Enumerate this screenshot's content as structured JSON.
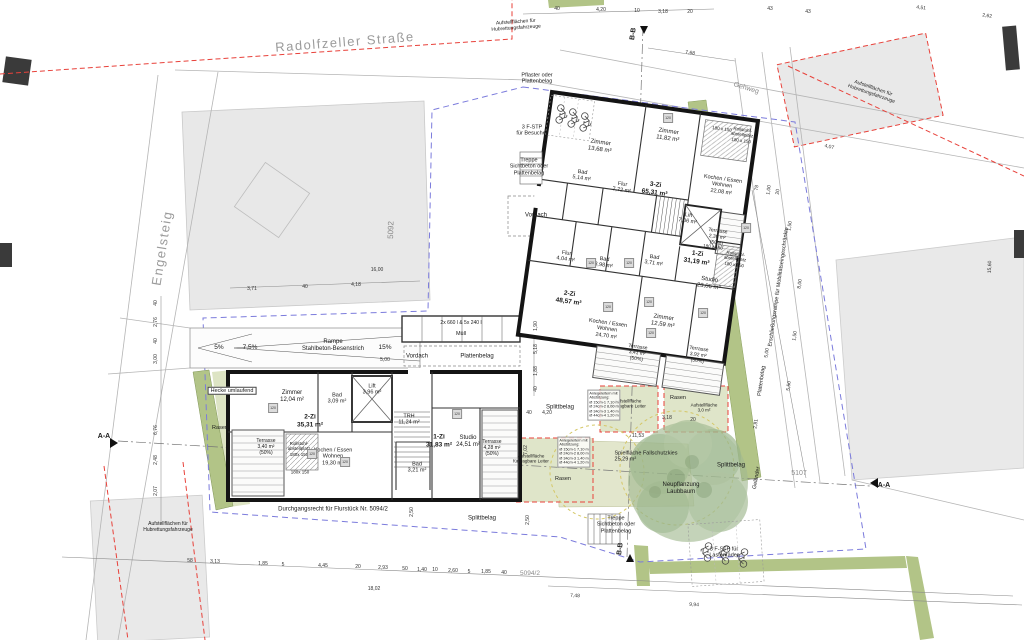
{
  "streets": {
    "main": "Radolfzeller Straße",
    "side": "Engelsteig",
    "gehweg": "Gehweg"
  },
  "parcels": {
    "p5092": "5092",
    "p5107": "5107",
    "p5094": "5094/2"
  },
  "fire": {
    "hub": "Aufstellflächen für\nHubrettungsfahrzeuge",
    "ladder": "Aufstellfläche\nfür tragbare Leiter",
    "ladder2": "Aufstellfläche\n3,0 m²",
    "ladder_note": "Anlegeleitern mit\nAbstützung:\nØ 15cm-1  7,10 m\nØ 24cm-2  8,00 m\nØ 34cm-3  1,40 m\nØ 44cm-4  1,20 m",
    "rasen": "Rasen"
  },
  "landscape": {
    "hecke": "Hecke umlaufend",
    "rasen": "Rasen",
    "spielflaeche": "Spielfläche Fallschutzkies\n25,29 m²",
    "baum": "Neupflanzung\nLaubbaum"
  },
  "surfaces": {
    "pflaster": "Pflaster oder\nPlattenbelag",
    "treppe": "Treppe\nSichtbeton oder\nPlattenbelag",
    "splittbelag": "Splittbelag",
    "plattenbelag": "Plattenbelag",
    "vordach": "Vordach",
    "muell_line1": "2x 660 l  &  5x 240 l",
    "muell_line2": "Müll",
    "rampe": "Rampe\nStahlbeton-Besenstrich",
    "pct5": "5%",
    "pct75": "7,5%",
    "pct15": "15%",
    "durchgangsrecht": "Durchgangsrecht für Flurstück Nr. 5094/2",
    "stp_besucher": "3 F-STP\nfür Besucher",
    "stp_lasten": "3 F-STP für\nLastenräder",
    "erschliessung": "Erschließungsrampe für Mobilitätseingeschränkte",
    "gelaender": "Geländer"
  },
  "sections": {
    "aa": "A-A",
    "bb": "B-B"
  },
  "rooms_upper": {
    "zimmer1": "Zimmer\n13,68 m²",
    "zimmer2": "Zimmer\n11,82 m²",
    "bad1": "Bad\n5,14 m²",
    "flur1": "Flur\n7,72 m²",
    "unit3": "3-Zi\n65,31 m²",
    "kochen1": "Kochen / Essen\nWohnen\n22,08 m²",
    "rollstuhl": "Rollstuhl-\nabstellplatz\n180 x 150",
    "turn": "180 x 150",
    "lift": "Lift\n7,06 m²",
    "terr_ost": "Terrasse\n2,39 m²\n(50%)",
    "flur2": "Flur\n4,04 m²",
    "bad2": "Bad\n3,98 m²",
    "bad3": "Bad\n3,71 m²",
    "unit1": "1-Zi\n31,19 m²",
    "studio": "Studio\n23,06 m²",
    "unit2": "2-Zi\n48,57 m²",
    "zimmer3": "Zimmer\n12,59 m²",
    "kochen2": "Kochen / Essen\nWohnen\n24,70 m²",
    "terr1": "Terrasse\n3,41 m²\n(50%)",
    "terr2": "Terrasse\n3,92 m²\n(50%)"
  },
  "rooms_lower": {
    "zimmer": "Zimmer\n12,04 m²",
    "bad1": "Bad\n3,09 m²",
    "lift": "Lift\n3,96 m²",
    "unit2": "2-Zi\n35,31 m²",
    "trh": "TRH\n11,24 m²",
    "terr1": "Terrasse\n3,40 m²\n(50%)",
    "rollstuhl": "Rollstuhl-\nabstellplatz\n180x 150",
    "kochen": "Kochen / Essen\nWohnen\n19,30 m²",
    "turn": "180x 150",
    "unit1": "1-Zi\n31,83 m²",
    "studio": "Studio\n24,51 m²",
    "terr2": "Terrasse\n4,28 m²\n(50%)",
    "bad2": "Bad\n3,21 m²"
  },
  "dims": {
    "t1": "40",
    "t2": "4,20",
    "t3": "10",
    "t4": "3,18",
    "t5": "20",
    "t6": "7,68",
    "t7": "43",
    "t8": "43",
    "t9": "4,51",
    "t10": "2,62",
    "lf1": "3,71",
    "lf2": "40",
    "lf3": "4,18",
    "lf4": "16,00",
    "lv1": "40",
    "lv2": "2,76",
    "lv3": "40",
    "lv4": "3,00",
    "lv5": "6,76",
    "lv6": "2,48",
    "lv7": "2,07",
    "mv1": "1,90",
    "mv2": "5,18",
    "mv3": "1,88",
    "mv4": "40",
    "mv5": "7,02",
    "m6": "40",
    "m7": "4,20",
    "m8": "11,53",
    "m9": "3,18",
    "m10": "20",
    "m11": "5,00",
    "r1": "78",
    "r2": "1,00",
    "r3": "20",
    "r4": "1,50",
    "r5": "8,00",
    "r6": "1,50",
    "r7": "5,00",
    "r8": "5,50",
    "r9": "2,81",
    "r10": "15,60",
    "r11": "4,07",
    "b1": "58",
    "b2": "3,13",
    "b3": "1,85",
    "b4": "5",
    "b5": "4,45",
    "b6": "20",
    "b7": "2,93",
    "b8": "50",
    "b9": "1,40",
    "b10": "10",
    "b11": "2,60",
    "b12": "5",
    "b13": "1,85",
    "b14": "40",
    "b15": "18,02",
    "b16": "7,48",
    "b17": "9,94",
    "dd1": "2,50",
    "dd2": "2,50"
  },
  "misc": {
    "fixture": "120"
  }
}
